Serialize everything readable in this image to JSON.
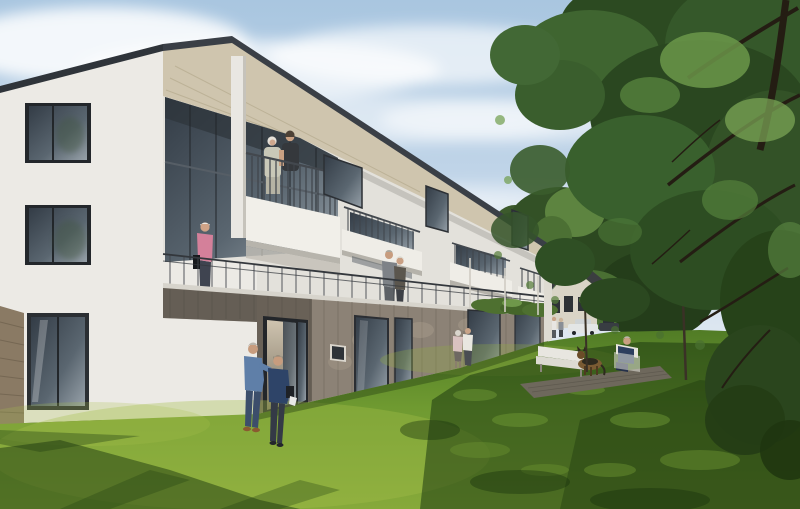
{
  "meta": {
    "title": "Architectural visualization - three-storey residential building with garden",
    "image_type": "photorealistic architectural rendering",
    "conditions": "sunny daytime, blue sky with soft clouds"
  },
  "colors": {
    "sky_top": "#a9c6e0",
    "sky_horizon": "#ebeff4",
    "cloud": "#ffffff",
    "facade": "#eceae5",
    "facade_side": "#e3e1db",
    "roof_fascia": "#3a3f46",
    "roof_soffit": "#cfc5ae",
    "glass_dark": "#333c46",
    "railing_metal": "#3c4046",
    "timber_cladding": "#8c8276",
    "timber_side": "#8a7a64",
    "balcony_white": "#f1efe9",
    "grass_front": "#86a93a",
    "grass_back": "#4f7a25",
    "grass_shadow": "#1e3a10",
    "grass_sunlit": "#a7bf4b",
    "tree_dark": "#2a4720",
    "tree_mid": "#39602d",
    "tree_light": "#6f9c4c",
    "branch": "#241d13",
    "house_roof": "#3b3e40",
    "house_wall": "#d9d4c6",
    "car_white": "#e3e6e6",
    "car_dark": "#383d42",
    "deck_timber": "#6e685c",
    "furniture_white": "#e8e6e0",
    "skin": "#c79c7e",
    "hair_grey": "#e5e1da",
    "shirt_blue": "#5f7fa8",
    "jeans_blue": "#3c4e6b",
    "coat_blue": "#2e4468",
    "shirt_pink": "#d4809a",
    "polo_black": "#35383c",
    "cardigan_sage": "#c9c8b8",
    "suit_grey": "#7e8287",
    "dog_brown": "#7a5b33",
    "dog_black": "#2e2a1e"
  },
  "scene": {
    "building": {
      "label": "new three-storey residential building",
      "storeys": 3,
      "features": [
        "mono-pitch overhanging roof",
        "white rendered upper floors",
        "timber-clad ground floor",
        "corner loggia with roofed balcony",
        "projecting balconies with slatted metal railings",
        "first-floor access walkway",
        "full-height glazing",
        "open entrance door",
        "green planting strip on ground-floor roof"
      ]
    },
    "background": {
      "label": "existing gabled house with dark pitched roof",
      "vehicles": [
        "white car",
        "dark car"
      ]
    },
    "garden": {
      "label": "lawn with long tree shadows",
      "furniture": [
        "white garden bench",
        "white garden armchair",
        "timber deck"
      ],
      "animals": [
        "german shepherd dog"
      ],
      "planting": [
        "large deciduous tree",
        "young saplings"
      ]
    },
    "people": [
      {
        "label": "elderly woman with carer on top-floor balcony"
      },
      {
        "label": "woman in pink shirt on first-floor walkway"
      },
      {
        "label": "couple talking on first-floor walkway"
      },
      {
        "label": "elderly man in blue shirt walking on lawn"
      },
      {
        "label": "elderly woman in blue coat with handbag"
      },
      {
        "label": "couple standing at ground-floor terrace"
      },
      {
        "label": "two residents beside parked cars"
      },
      {
        "label": "man seated in garden armchair"
      }
    ]
  }
}
